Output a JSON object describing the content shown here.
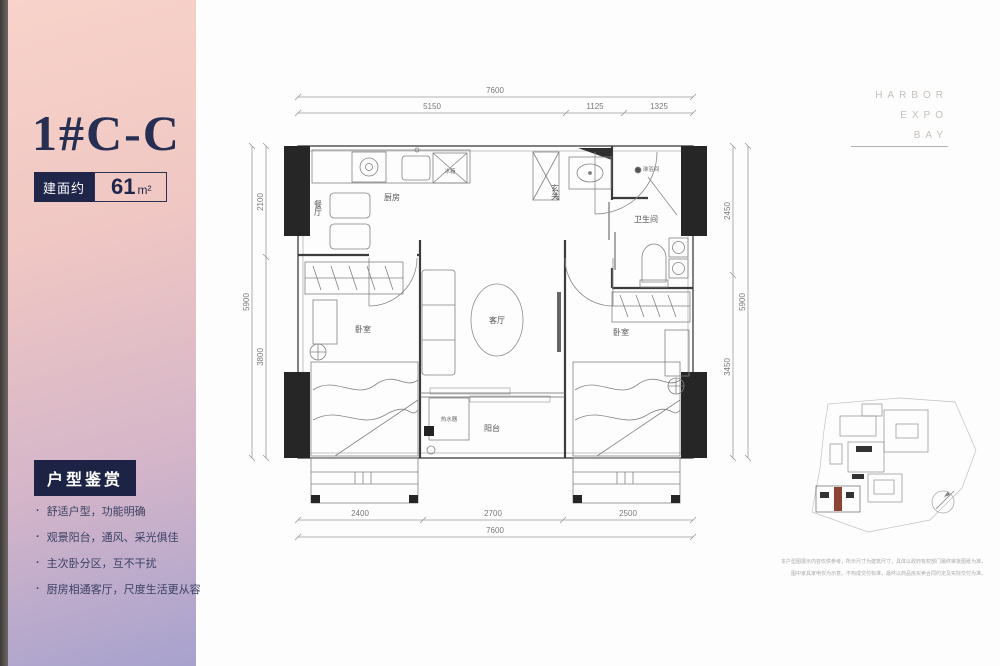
{
  "sidebar": {
    "title": "1#C-C",
    "area_label": "建面约",
    "area_value": "61",
    "area_unit": "m²",
    "section_title": "户型鉴赏",
    "bullets": [
      "舒适户型，功能明确",
      "观景阳台，通风、采光俱佳",
      "主次卧分区，互不干扰",
      "厨房相通客厅，尺度生活更从容"
    ]
  },
  "brand": {
    "line1": "HARBOR",
    "line2": "EXPO",
    "line3": "BAY"
  },
  "floorplan": {
    "rooms": {
      "kitchen": "厨房",
      "dining": "餐厅",
      "entry": "玄关",
      "shower": "淋浴间",
      "bathroom": "卫生间",
      "living": "客厅",
      "bedroom_left": "卧室",
      "bedroom_right": "卧室",
      "balcony": "阳台",
      "water_heater": "热水器",
      "fridge": "冰箱"
    },
    "dims": {
      "top_total": "7600",
      "top_seg1": "5150",
      "top_seg2": "1125",
      "top_seg3": "1325",
      "bottom_seg1": "2400",
      "bottom_seg2": "2700",
      "bottom_seg3": "2500",
      "bottom_total": "7600",
      "left_seg1": "2100",
      "left_seg2": "3800",
      "left_total": "5900",
      "right_seg1": "2450",
      "right_seg2": "3450",
      "right_total": "5900"
    }
  },
  "disclaimer": {
    "line1": "本户型图展示内容仅供参考，所示尺寸为建筑尺寸，具体以政府有权部门最终审批图纸为准，",
    "line2": "图中家具家电仅为示意，不构成交付标准，最终以商品房买卖合同约定及实际交付为准。"
  }
}
